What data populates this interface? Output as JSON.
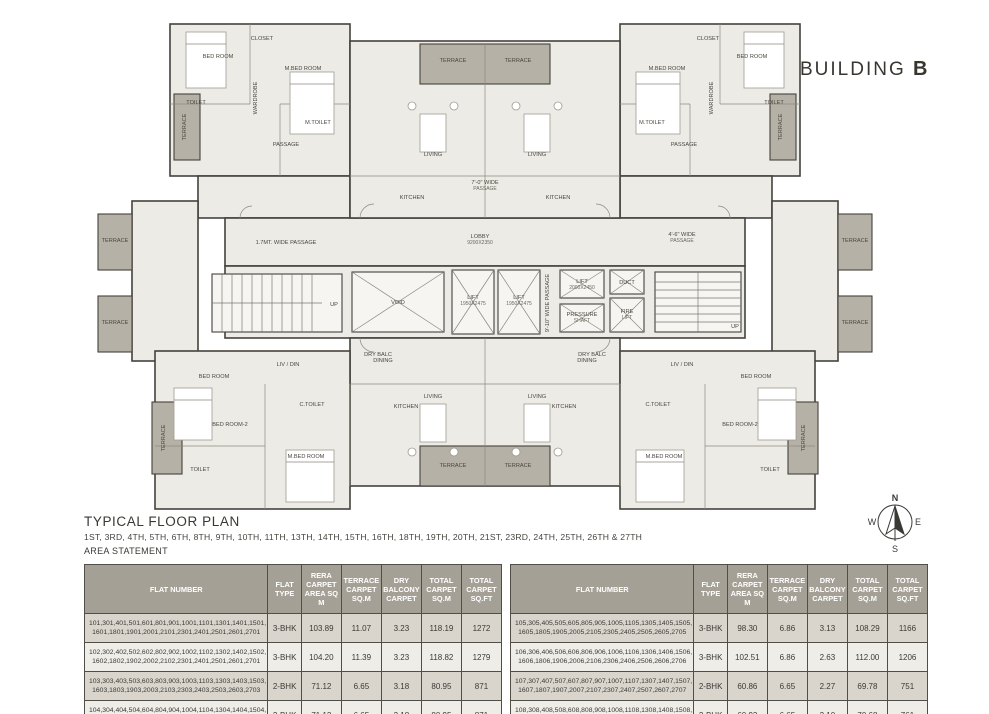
{
  "building_title": {
    "prefix": "BUILDING",
    "letter": "B"
  },
  "plan_title": "TYPICAL FLOOR PLAN",
  "floors_line": "1ST, 3RD, 4TH, 5TH, 6TH, 8TH, 9TH, 10TH, 11TH, 13TH, 14TH, 15TH, 16TH, 18TH, 19TH, 20TH, 21ST, 23RD, 24TH, 25TH, 26TH & 27TH",
  "area_statement_label": "AREA STATEMENT",
  "compass": {
    "n": "N",
    "e": "E",
    "s": "S",
    "w": "W"
  },
  "colors": {
    "wall": "#45423d",
    "room_fill": "#edebe6",
    "terrace_fill": "#b5b1a7",
    "header_bg": "#a5a096",
    "row_odd": "#d9d5cc",
    "row_even": "#efede8"
  },
  "tables": {
    "headers": [
      "FLAT NUMBER",
      "FLAT TYPE",
      "RERA CARPET AREA SQ M",
      "TERRACE CARPET SQ.M",
      "DRY BALCONY CARPET",
      "TOTAL CARPET SQ.M",
      "TOTAL CARPET SQ.FT"
    ],
    "left": {
      "rows": [
        {
          "flats": "101,301,401,501,601,801,901,1001,1101,1301,1401,1501, 1601,1801,1901,2001,2101,2301,2401,2501,2601,2701",
          "type": "3-BHK",
          "rera": "103.89",
          "terrace": "11.07",
          "dry": "3.23",
          "total_sqm": "118.19",
          "total_sqft": "1272"
        },
        {
          "flats": "102,302,402,502,602,802,902,1002,1102,1302,1402,1502, 1602,1802,1902,2002,2102,2301,2401,2501,2601,2701",
          "type": "3-BHK",
          "rera": "104.20",
          "terrace": "11.39",
          "dry": "3.23",
          "total_sqm": "118.82",
          "total_sqft": "1279"
        },
        {
          "flats": "103,303,403,503,603,803,903,1003,1103,1303,1403,1503, 1603,1803,1903,2003,2103,2303,2403,2503,2603,2703",
          "type": "2-BHK",
          "rera": "71.12",
          "terrace": "6.65",
          "dry": "3.18",
          "total_sqm": "80.95",
          "total_sqft": "871"
        },
        {
          "flats": "104,304,404,504,604,804,904,1004,1104,1304,1404,1504, 1604,1804,1904,2004,2104,2304,2404,2504,2604,2704",
          "type": "2-BHK",
          "rera": "71.12",
          "terrace": "6.65",
          "dry": "3.18",
          "total_sqm": "80.95",
          "total_sqft": "871"
        }
      ]
    },
    "right": {
      "rows": [
        {
          "flats": "105,305,405,505,605,805,905,1005,1105,1305,1405,1505, 1605,1805,1905,2005,2105,2305,2405,2505,2605,2705",
          "type": "3-BHK",
          "rera": "98.30",
          "terrace": "6.86",
          "dry": "3.13",
          "total_sqm": "108.29",
          "total_sqft": "1166"
        },
        {
          "flats": "106,306,406,506,606,806,906,1006,1106,1306,1406,1506, 1606,1806,1906,2006,2106,2306,2406,2506,2606,2706",
          "type": "3-BHK",
          "rera": "102.51",
          "terrace": "6.86",
          "dry": "2.63",
          "total_sqm": "112.00",
          "total_sqft": "1206"
        },
        {
          "flats": "107,307,407,507,607,807,907,1007,1107,1307,1407,1507, 1607,1807,1907,2007,2107,2307,2407,2507,2607,2707",
          "type": "2-BHK",
          "rera": "60.86",
          "terrace": "6.65",
          "dry": "2.27",
          "total_sqm": "69.78",
          "total_sqft": "751"
        },
        {
          "flats": "108,308,408,508,608,808,908,1008,1108,1308,1408,1508, 1608,1808,1908,2008,2108,2308,2408,2508,2608,2708",
          "type": "2-BHK",
          "rera": "60.93",
          "terrace": "6.65",
          "dry": "3.10",
          "total_sqm": "70.68",
          "total_sqft": "761"
        }
      ]
    }
  },
  "plan": {
    "labels": [
      {
        "t": "LOBBY",
        "d": "9200X2350",
        "x": 390,
        "y": 232
      },
      {
        "t": "1.7MT. WIDE PASSAGE",
        "x": 196,
        "y": 238
      },
      {
        "t": "4'-6\" WIDE",
        "d": "PASSAGE",
        "x": 592,
        "y": 230
      },
      {
        "t": "7'-0\" WIDE",
        "d": "PASSAGE",
        "x": 395,
        "y": 178
      },
      {
        "t": "9'-10\" WIDE PASSAGE",
        "x": 459,
        "y": 297,
        "r": -90
      },
      {
        "t": "VOID",
        "x": 308,
        "y": 298
      },
      {
        "t": "LIFT",
        "d": "1950X2475",
        "x": 383,
        "y": 293
      },
      {
        "t": "LIFT",
        "d": "1950X2475",
        "x": 429,
        "y": 293
      },
      {
        "t": "LIFT",
        "d": "2000X2450",
        "x": 492,
        "y": 277
      },
      {
        "t": "PRESSURE",
        "d": "SHAFT",
        "x": 492,
        "y": 310
      },
      {
        "t": "DUCT",
        "x": 537,
        "y": 278
      },
      {
        "t": "FIRE",
        "d": "LIFT",
        "x": 537,
        "y": 307
      },
      {
        "t": "UP",
        "x": 244,
        "y": 300
      },
      {
        "t": "UP",
        "x": 645,
        "y": 322
      },
      {
        "t": "TERRACE",
        "x": 363,
        "y": 56
      },
      {
        "t": "TERRACE",
        "x": 428,
        "y": 56
      },
      {
        "t": "LIVING",
        "x": 343,
        "y": 150
      },
      {
        "t": "LIVING",
        "x": 447,
        "y": 150
      },
      {
        "t": "KITCHEN",
        "x": 322,
        "y": 193
      },
      {
        "t": "KITCHEN",
        "x": 468,
        "y": 193
      },
      {
        "t": "KITCHEN",
        "x": 316,
        "y": 402
      },
      {
        "t": "KITCHEN",
        "x": 474,
        "y": 402
      },
      {
        "t": "DINING",
        "x": 293,
        "y": 356
      },
      {
        "t": "DINING",
        "x": 497,
        "y": 356
      },
      {
        "t": "LIVING",
        "x": 343,
        "y": 392
      },
      {
        "t": "LIVING",
        "x": 447,
        "y": 392
      },
      {
        "t": "TERRACE",
        "x": 363,
        "y": 461
      },
      {
        "t": "TERRACE",
        "x": 428,
        "y": 461
      },
      {
        "t": "BED ROOM",
        "x": 128,
        "y": 52
      },
      {
        "t": "M.BED ROOM",
        "x": 213,
        "y": 64
      },
      {
        "t": "CLOSET",
        "x": 172,
        "y": 34
      },
      {
        "t": "TOILET",
        "x": 106,
        "y": 98
      },
      {
        "t": "M.TOILET",
        "x": 228,
        "y": 118
      },
      {
        "t": "PASSAGE",
        "x": 196,
        "y": 140
      },
      {
        "t": "WARDROBE",
        "x": 167,
        "y": 92,
        "r": -90
      },
      {
        "t": "BED ROOM",
        "x": 662,
        "y": 52
      },
      {
        "t": "M.BED ROOM",
        "x": 577,
        "y": 64
      },
      {
        "t": "CLOSET",
        "x": 618,
        "y": 34
      },
      {
        "t": "TOILET",
        "x": 684,
        "y": 98
      },
      {
        "t": "M.TOILET",
        "x": 562,
        "y": 118
      },
      {
        "t": "PASSAGE",
        "x": 594,
        "y": 140
      },
      {
        "t": "WARDROBE",
        "x": 623,
        "y": 92,
        "r": -90
      },
      {
        "t": "TERRACE",
        "x": 96,
        "y": 121,
        "r": -90
      },
      {
        "t": "TERRACE",
        "x": 692,
        "y": 121,
        "r": -90
      },
      {
        "t": "TERRACE",
        "x": 25,
        "y": 236
      },
      {
        "t": "TERRACE",
        "x": 25,
        "y": 318
      },
      {
        "t": "TERRACE",
        "x": 765,
        "y": 236
      },
      {
        "t": "TERRACE",
        "x": 765,
        "y": 318
      },
      {
        "t": "LIV / DIN",
        "x": 198,
        "y": 360
      },
      {
        "t": "LIV / DIN",
        "x": 592,
        "y": 360
      },
      {
        "t": "DRY BALC",
        "x": 288,
        "y": 350
      },
      {
        "t": "DRY BALC",
        "x": 502,
        "y": 350
      },
      {
        "t": "BED ROOM",
        "x": 124,
        "y": 372
      },
      {
        "t": "BED ROOM-2",
        "x": 140,
        "y": 420
      },
      {
        "t": "M.BED ROOM",
        "x": 216,
        "y": 452
      },
      {
        "t": "TOILET",
        "x": 110,
        "y": 465
      },
      {
        "t": "C.TOILET",
        "x": 222,
        "y": 400
      },
      {
        "t": "TERRACE",
        "x": 75,
        "y": 432,
        "r": -90
      },
      {
        "t": "BED ROOM",
        "x": 666,
        "y": 372
      },
      {
        "t": "BED ROOM-2",
        "x": 650,
        "y": 420
      },
      {
        "t": "M.BED ROOM",
        "x": 574,
        "y": 452
      },
      {
        "t": "TOILET",
        "x": 680,
        "y": 465
      },
      {
        "t": "C.TOILET",
        "x": 568,
        "y": 400
      },
      {
        "t": "TERRACE",
        "x": 715,
        "y": 432,
        "r": -90
      }
    ]
  }
}
